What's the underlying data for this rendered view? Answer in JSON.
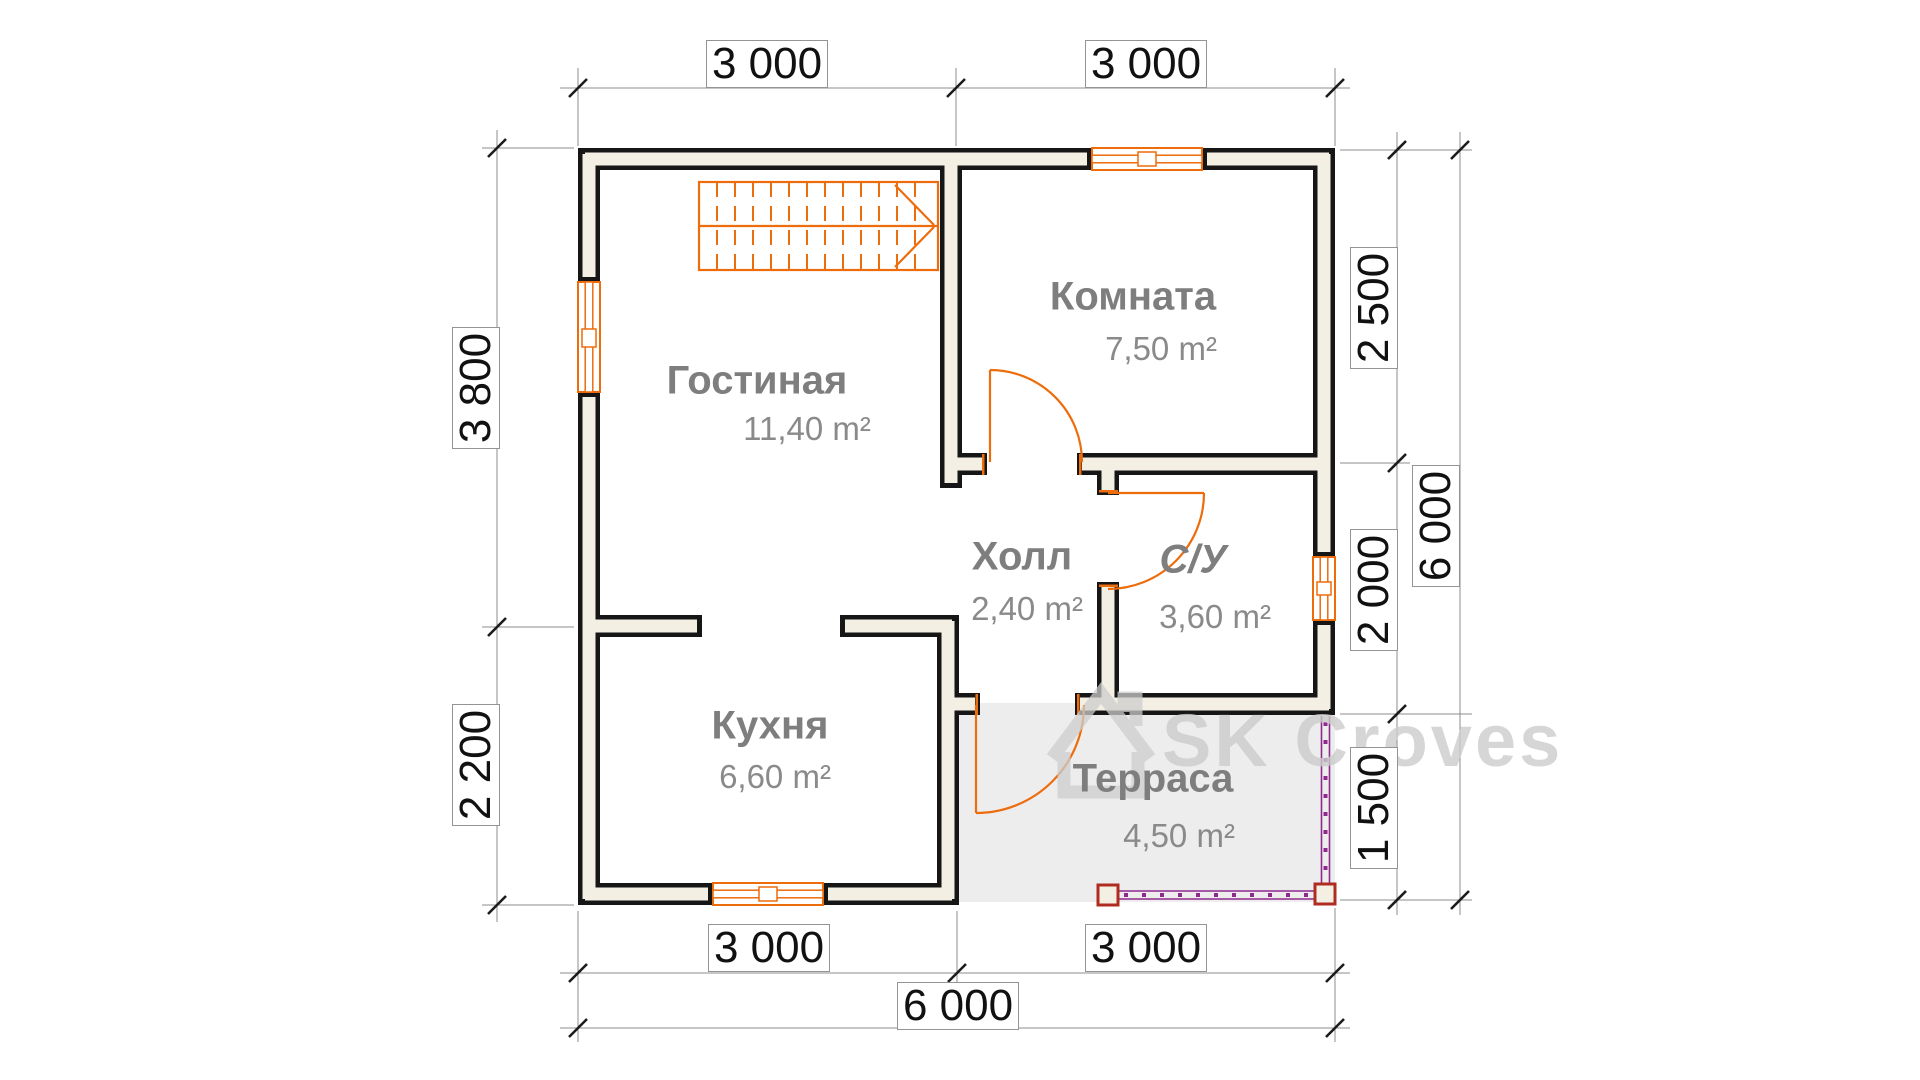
{
  "title": "Floor plan — first floor",
  "colors": {
    "wall_ink": "#161616",
    "wall_fill": "#f3efe2",
    "carpentry_orange": "#ed6c0c",
    "room_label_gray": "#7e7e7e",
    "terrace_fill": "#ededed",
    "terrace_rail_purple": "#8e2a8e",
    "terrace_post_red": "#b02c20",
    "dimension_line_gray": "#8c8c8c",
    "watermark_gray": "#cccccc"
  },
  "rooms": [
    {
      "name": "Гостиная",
      "area": "11,40 m²"
    },
    {
      "name": "Комната",
      "area": "7,50 m²"
    },
    {
      "name": "Холл",
      "area": "2,40 m²"
    },
    {
      "name": "С/У",
      "area": "3,60 m²"
    },
    {
      "name": "Кухня",
      "area": "6,60 m²"
    },
    {
      "name": "Терраса",
      "area": "4,50 m²"
    }
  ],
  "dimensions": {
    "top": [
      "3 000",
      "3 000"
    ],
    "bottom_inner": [
      "3 000",
      "3 000"
    ],
    "bottom_outer": "6 000",
    "left": [
      "3 800",
      "2 200"
    ],
    "right_inner": [
      "2 500",
      "2 000",
      "1 500"
    ],
    "right_outer": "6 000"
  },
  "watermark": {
    "text": "SK Croves"
  }
}
